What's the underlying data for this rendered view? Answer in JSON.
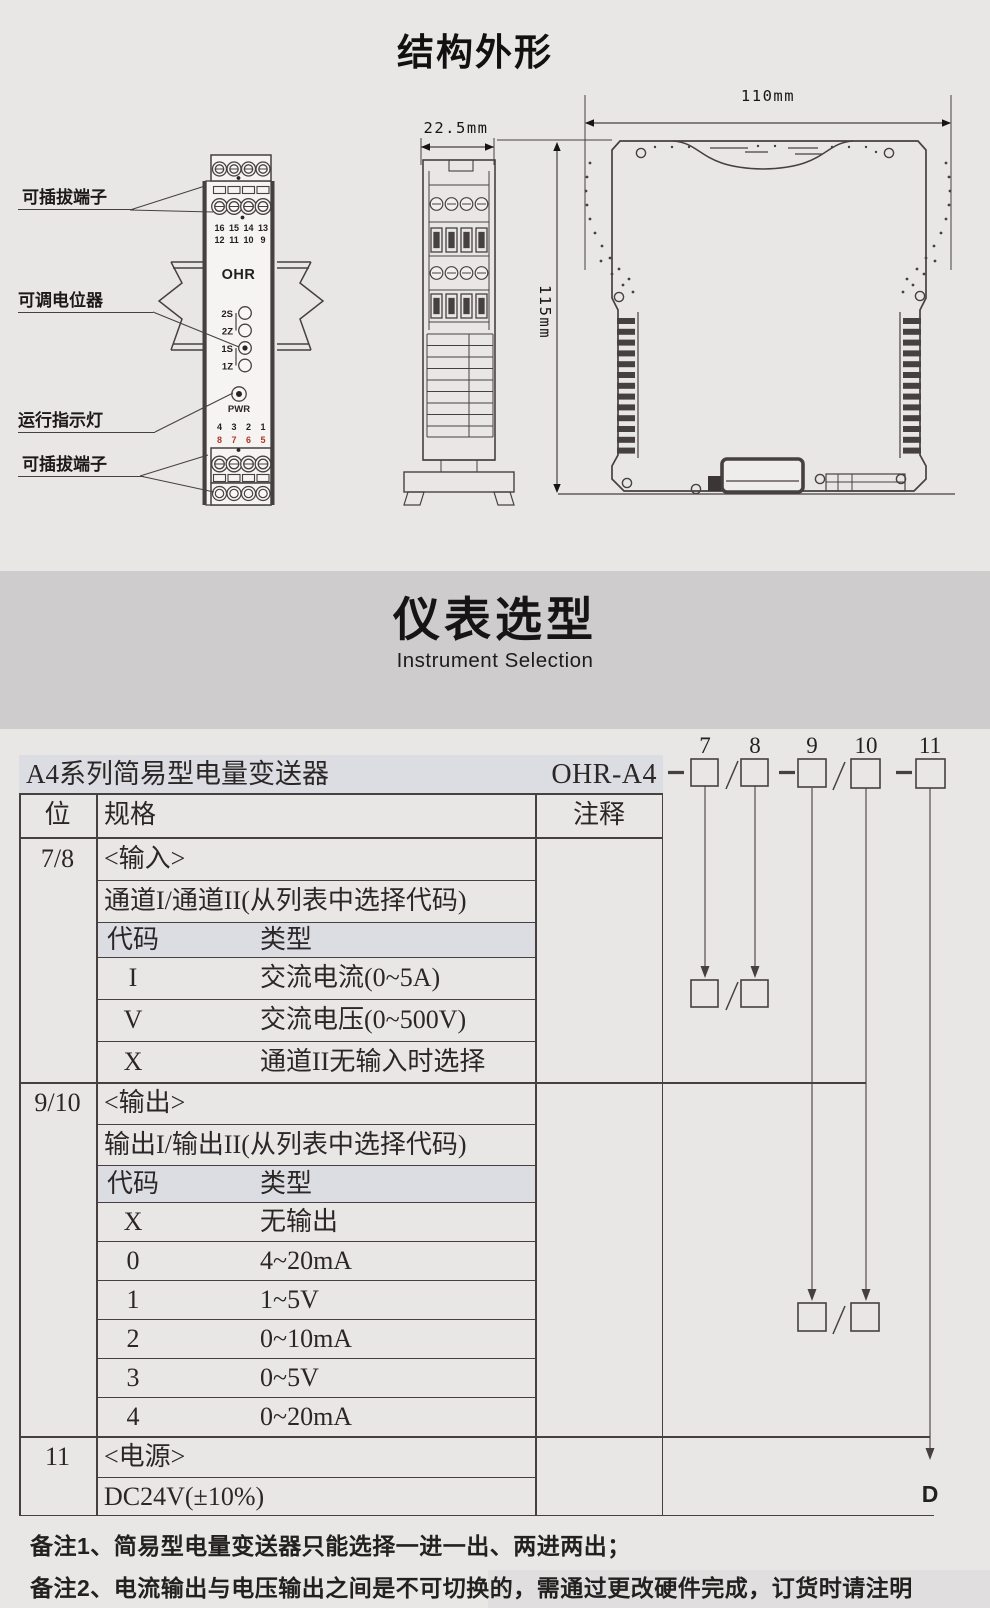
{
  "structure": {
    "title": "结构外形",
    "callouts": [
      "可插拔端子",
      "可调电位器",
      "运行指示灯",
      "可插拔端子"
    ],
    "front": {
      "brand": "OHR",
      "top_nums1": [
        "16",
        "15",
        "14",
        "13"
      ],
      "top_nums2": [
        "12",
        "11",
        "10",
        "9"
      ],
      "pots": [
        "2S",
        "2Z",
        "1S",
        "1Z"
      ],
      "pwr": "PWR",
      "bot_nums1": [
        "4",
        "3",
        "2",
        "1"
      ],
      "bot_nums2": [
        "8",
        "7",
        "6",
        "5"
      ]
    },
    "dims": {
      "side_width": "22.5mm",
      "height": "115mm",
      "front_width": "110mm"
    }
  },
  "banner": {
    "title": "仪表选型",
    "subtitle": "Instrument Selection"
  },
  "selection": {
    "product": "A4系列简易型电量变送器",
    "model": "OHR-A4",
    "digits": [
      "7",
      "8",
      "9",
      "10",
      "11"
    ],
    "d_label": "D",
    "headers": {
      "pos": "位",
      "spec": "规格",
      "note": "注释"
    },
    "sections": [
      {
        "pos": "7/8",
        "title": "<输入>",
        "desc": "通道I/通道II(从列表中选择代码)",
        "code_label": "代码",
        "type_label": "类型",
        "codes": [
          [
            "I",
            "交流电流(0~5A)"
          ],
          [
            "V",
            "交流电压(0~500V)"
          ],
          [
            "X",
            "通道II无输入时选择"
          ]
        ]
      },
      {
        "pos": "9/10",
        "title": "<输出>",
        "desc": "输出I/输出II(从列表中选择代码)",
        "code_label": "代码",
        "type_label": "类型",
        "codes": [
          [
            "X",
            "无输出"
          ],
          [
            "0",
            "4~20mA"
          ],
          [
            "1",
            "1~5V"
          ],
          [
            "2",
            "0~10mA"
          ],
          [
            "3",
            "0~5V"
          ],
          [
            "4",
            "0~20mA"
          ]
        ]
      },
      {
        "pos": "11",
        "title": "<电源>",
        "desc": "DC24V(±10%)",
        "code_label": "",
        "type_label": "",
        "codes": []
      }
    ]
  },
  "notes": [
    "备注1、简易型电量变送器只能选择一进一出、两进两出；",
    "备注2、电流输出与电压输出之间是不可切换的，需通过更改硬件完成，订货时请注明"
  ],
  "colors": {
    "page_bg": "#e9e7e6",
    "banner_bg": "#cecccc",
    "highlight": "#dcdde2",
    "line": "#474040",
    "red": "#b03528"
  }
}
